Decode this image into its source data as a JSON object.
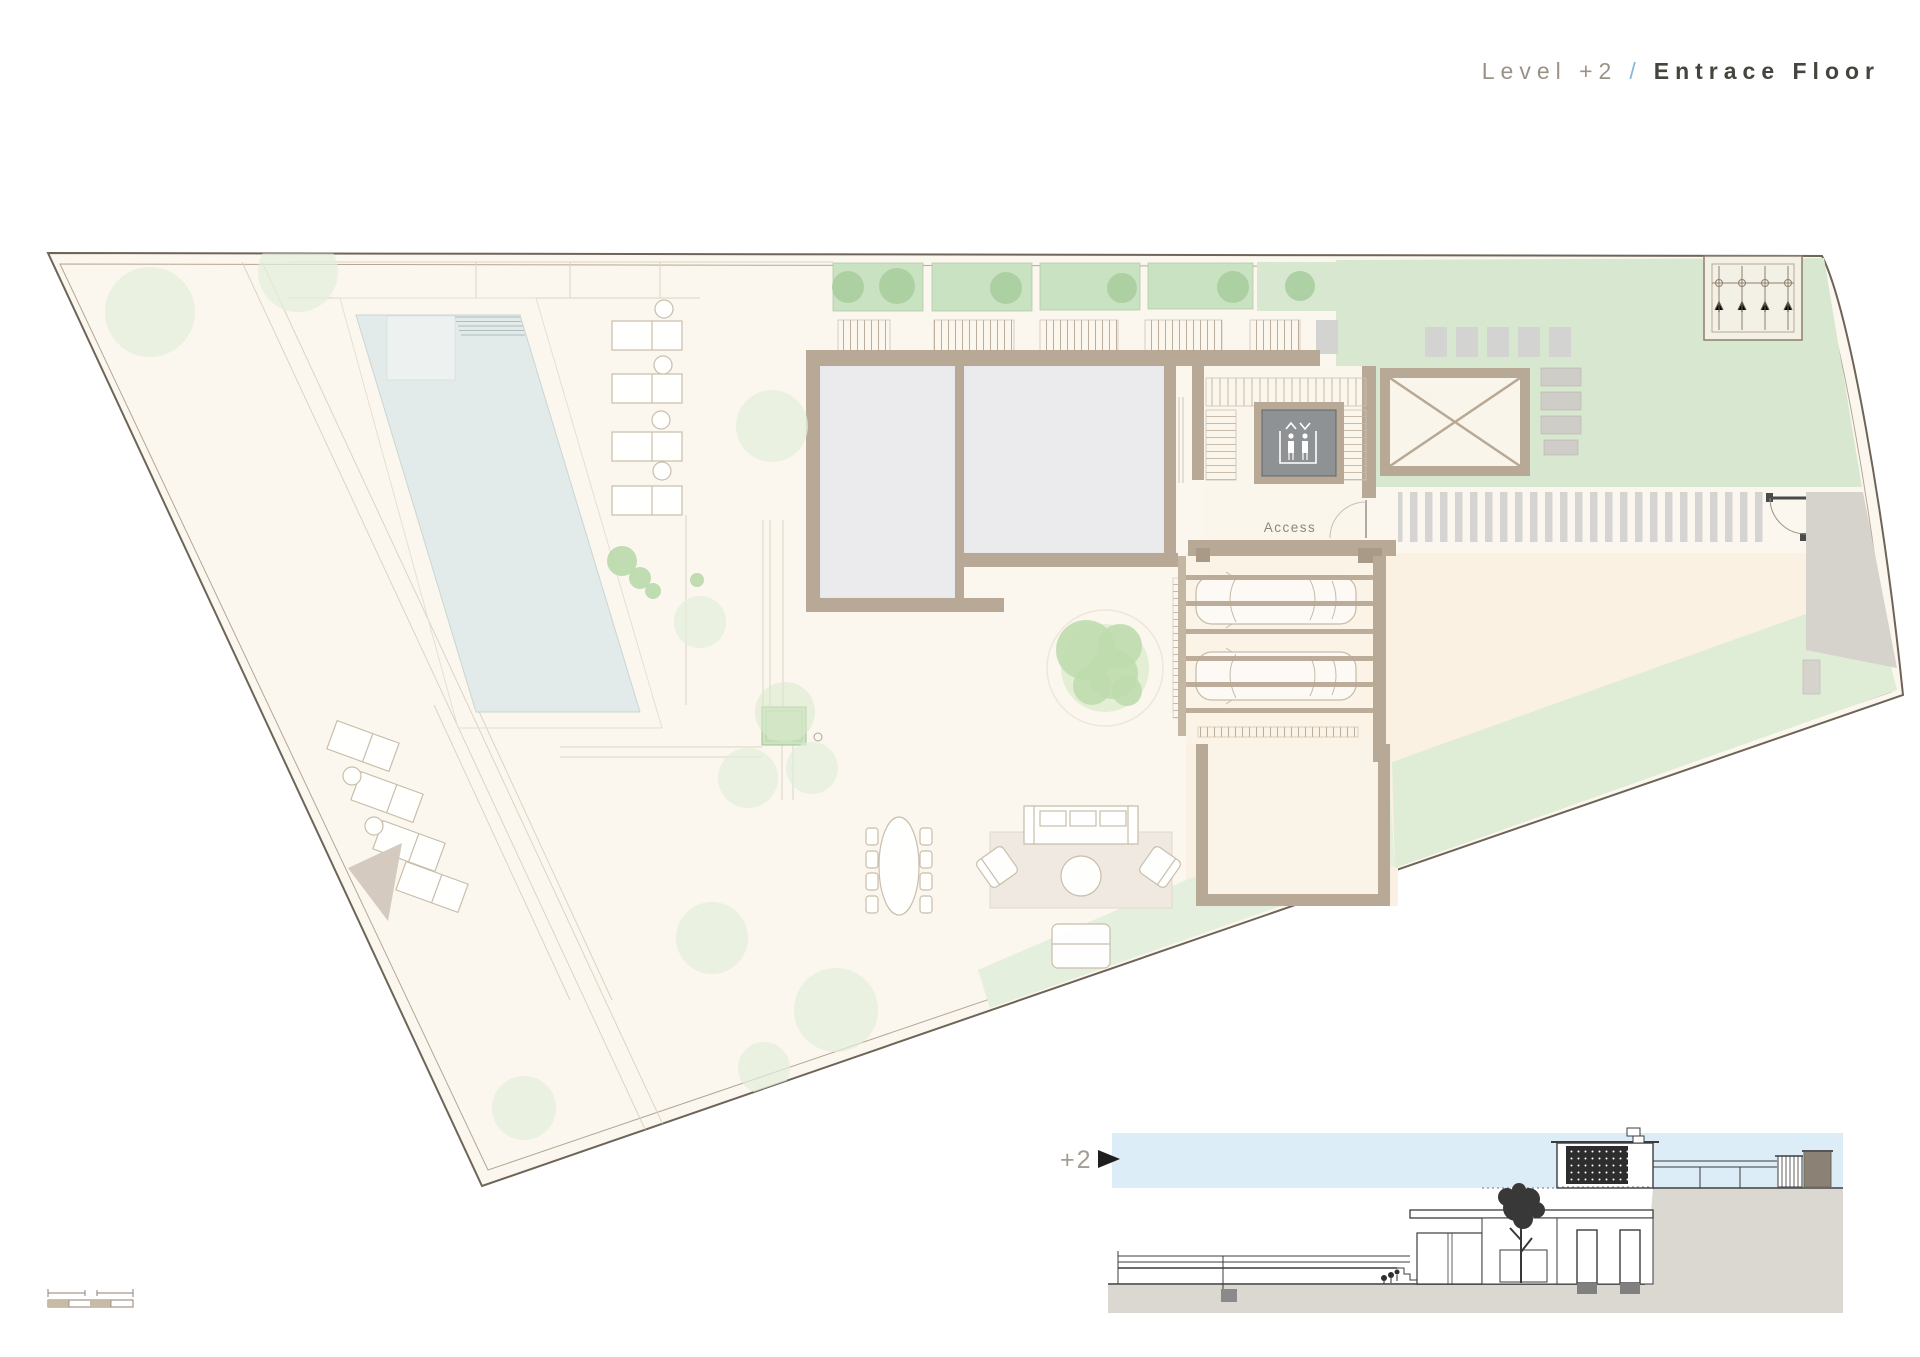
{
  "title": {
    "level": "Level +2",
    "separator": "/",
    "floor": "Entrace Floor"
  },
  "plan": {
    "access_label": "Access",
    "colors": {
      "site": "#FBF7EF",
      "boundary": "#6E6458",
      "wall_tan": "#B7A995",
      "upper_room_gray": "#EBEBED",
      "pool": "#E2EBEA",
      "pool_shelf": "#EDF2F0",
      "planter_green": "#C9E2C1",
      "tree_green": "#A9CE9E",
      "roof_garden": "#D8E8D0",
      "lawn_strip": "#E4EFDD",
      "terrace_peach": "#FAF1E3",
      "paving_bar": "#D5D4D2",
      "ramp_gray": "#D6D2CC",
      "elevator_gray": "#8E9295",
      "furniture_line": "#C8BEAC"
    }
  },
  "section": {
    "marker_label": "+2",
    "colors": {
      "sky": "#DCEDF8",
      "ground": "#DBD7D1",
      "dark_panel": "#2D2D2D"
    }
  },
  "icons": {
    "elevator": "elevator-people-icon",
    "door": "door-swing-icon",
    "gate": "gate-swing-icon",
    "section_marker": "level-arrow-icon",
    "storage_cross": "x-cross-room-icon"
  },
  "scale_bar": {
    "segment_count": 4,
    "segment_fill": "#C8BBA6"
  }
}
